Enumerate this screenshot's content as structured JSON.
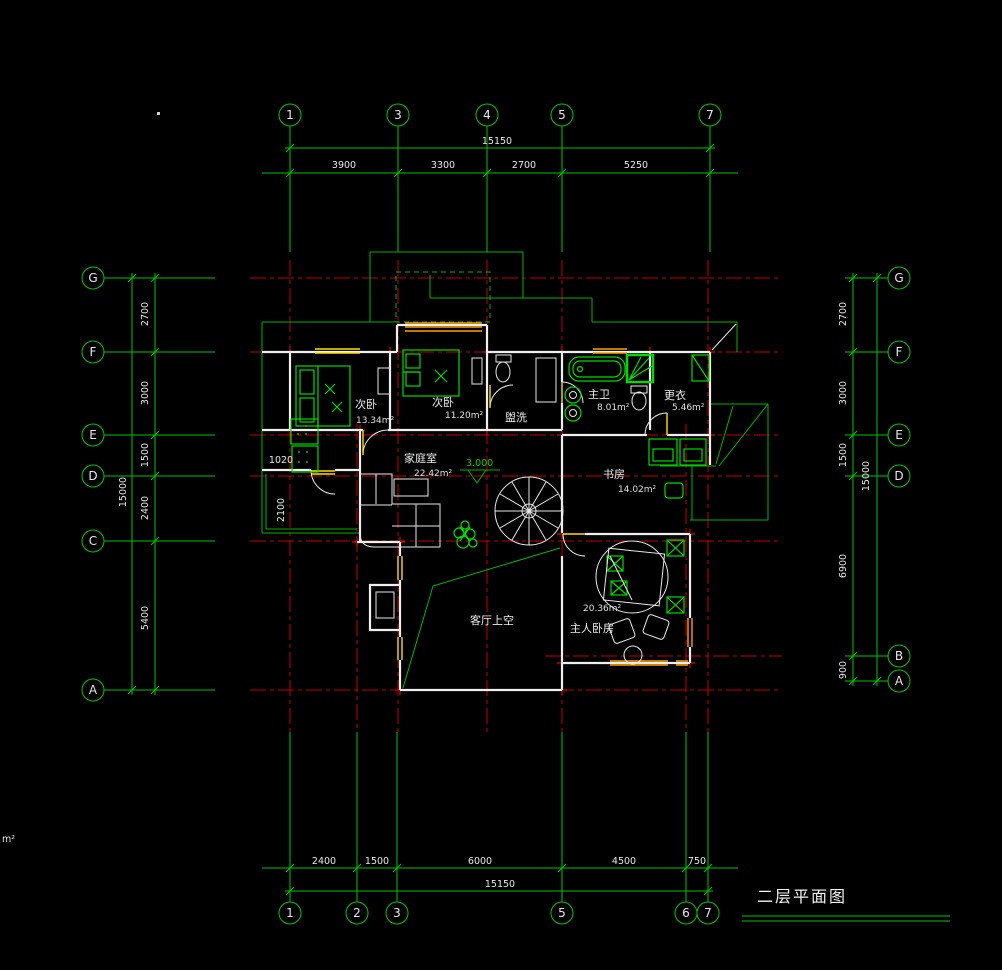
{
  "drawing": {
    "title": "二层平面图",
    "corner_label": "m²",
    "level_marker": "3.000"
  },
  "grid_bubbles": {
    "top": [
      "1",
      "3",
      "4",
      "5",
      "7"
    ],
    "bottom": [
      "1",
      "2",
      "3",
      "5",
      "6",
      "7"
    ],
    "left": [
      "G",
      "F",
      "E",
      "D",
      "C",
      "A"
    ],
    "right": [
      "G",
      "F",
      "E",
      "D",
      "B",
      "A"
    ]
  },
  "dimensions": {
    "top": {
      "total": "15150",
      "segments": [
        "3900",
        "3300",
        "2700",
        "5250"
      ]
    },
    "bottom": {
      "total": "15150",
      "segments": [
        "2400",
        "1500",
        "6000",
        "4500",
        "750"
      ]
    },
    "left": {
      "total": "15000",
      "segments": [
        "2700",
        "3000",
        "1500",
        "2400",
        "5400"
      ]
    },
    "right": {
      "total": "15000",
      "segments": [
        "2700",
        "3000",
        "1500",
        "6900",
        "900"
      ]
    },
    "interior": {
      "alcove_width": "1020",
      "balcony_depth": "2100"
    }
  },
  "rooms": [
    {
      "name": "次卧",
      "area": "13.34m²"
    },
    {
      "name": "次卧",
      "area": "11.20m²"
    },
    {
      "name": "盥洗",
      "area": ""
    },
    {
      "name": "主卫",
      "area": "8.01m²"
    },
    {
      "name": "更衣",
      "area": "5.46m²"
    },
    {
      "name": "家庭室",
      "area": "22.42m²"
    },
    {
      "name": "书房",
      "area": "14.02m²"
    },
    {
      "name": "主人卧房",
      "area": "20.36m²"
    },
    {
      "name": "客厅上空",
      "area": ""
    }
  ],
  "colors": {
    "background": "#000000",
    "grid_green": "#00c400",
    "centerline_red": "#cc0000",
    "wall_white": "#efefef",
    "window_orange": "#ffa000",
    "window_yellow": "#ffe000",
    "furniture_green": "#00dc00",
    "text_white": "#e8e8e8"
  }
}
